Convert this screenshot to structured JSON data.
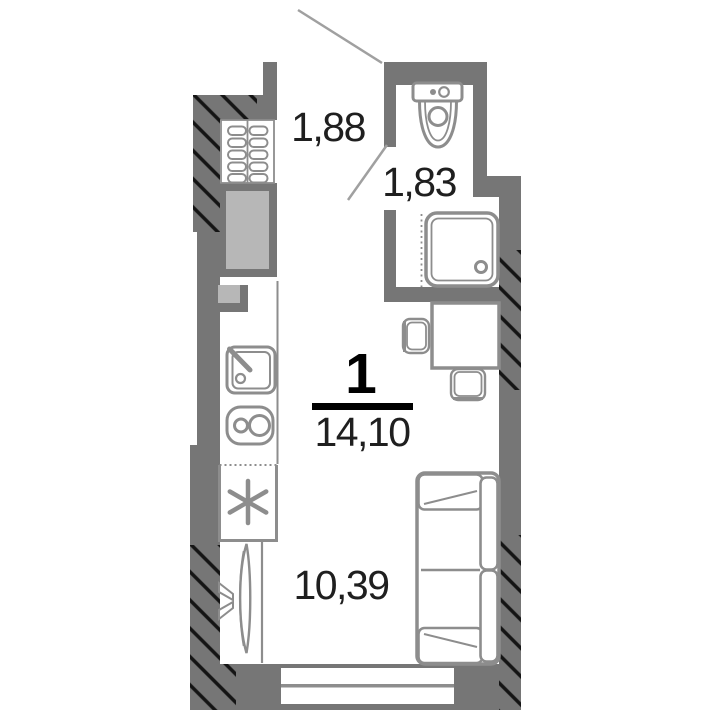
{
  "title": "Studio apartment floor plan",
  "unit": {
    "rooms_count": "1",
    "total_area": "14,10",
    "areas": {
      "hallway": "1,88",
      "bathroom": "1,83",
      "living_room": "10,39"
    }
  },
  "fixtures": {
    "bathroom": [
      "toilet",
      "shower-tray",
      "shower-screen"
    ],
    "hallway": [
      "radiator",
      "ventilation-shaft",
      "entrance-door-swing",
      "bathroom-door-swing"
    ],
    "kitchen": [
      "kitchen-sink",
      "stove-2-burners",
      "fridge-snowflake"
    ],
    "living_room": [
      "wall-tv",
      "desk",
      "chair",
      "chair",
      "sofa-2-seat",
      "window"
    ]
  },
  "colors": {
    "wall": "#767676",
    "shaft": "#b7b7b7",
    "stroke": "#8d8d8d",
    "hatch": "#141414",
    "text": "#1f1f1f",
    "black": "#000000",
    "door": "#a0a0a0"
  }
}
